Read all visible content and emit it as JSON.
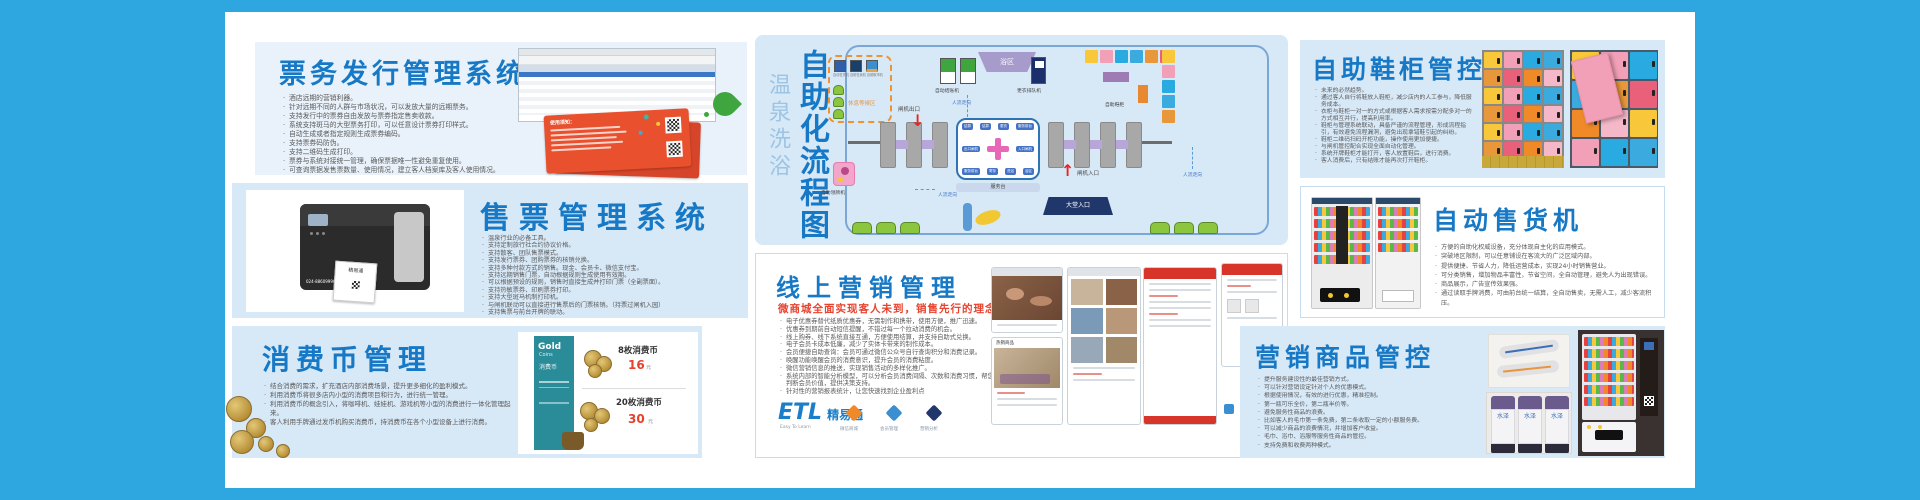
{
  "colors": {
    "frame_blue": "#2EA7E0",
    "panel_blue": "#D7E8F7",
    "title_blue": "#1779C6",
    "accent_red": "#E8432F",
    "dash_orange": "#F0932F",
    "gold_teal": "#2A8C99"
  },
  "ticket_issuing": {
    "title": "票务发行管理系统",
    "bullets": [
      "酒店远期的营销利器。",
      "针对远期不同的人群与市场状况，可以发放大量的远期票务。",
      "支持发行中的票券自由发放与票券指定售卖收款。",
      "系统支持斑马的大型票务打印，可以任意设计票券打印样式。",
      "自动生成或者指定规则生成票券编码。",
      "支持票券码防伪。",
      "支持二维码生成打印。",
      "票券与系统对接统一管理，确保票据唯一性避免重复使用。",
      "可查询票据发售票数量、使用情况，建立客人档案库及客人使用情况。"
    ],
    "ticket_heading": "使用须知："
  },
  "ticket_sales": {
    "title": "售票管理系统",
    "bullets": [
      "温泉行业的必备工具。",
      "支持定制旅行社合约协议价格。",
      "支持散客、团队售票模式。",
      "支持发行票券、团购票券的核销兑换。",
      "支持多种付款方式的销售。现金、会员卡、微信支付宝。",
      "支持远期销售门票，自动根据规则生成使用有效期。",
      "可以根据预设的规则，销售时直接生成并打印门票（全副票面）。",
      "支持热敏票券、印刷票券打印。",
      "支持大型斑马机制打印机。",
      "与闸机联动可以直接进行售票后的门票核销。（持票过闸机入园）",
      "支持售票与前台开牌的联动。"
    ],
    "printer_phone": "024-88609996",
    "printer_label": "精易通"
  },
  "consume_coin": {
    "title": "消费币管理",
    "bullets": [
      "结合消费的需求，扩充酒店内部消费场景，提升更多细化的盈利模式。",
      "利用消费币将很多店内小型的消费项目和行为，进行统一管理。",
      "利用消费币的概念引入，将咖啡机、娃娃机、游戏机等小型的消费进行一体化管理起来。",
      "客人利用手牌通过发币机购买消费币，持消费币在各个小型设备上进行消费。"
    ],
    "card": {
      "brand": "Gold",
      "brand_sub": "Coins",
      "brand_cn": "消费币",
      "item1_name": "8枚消费币",
      "item1_price": "16",
      "item1_unit": "元",
      "item2_name": "20枚消费币",
      "item2_price": "30",
      "item2_unit": "元"
    }
  },
  "flowchart": {
    "title_light": "温泉洗浴",
    "title_bold": "自助化流程图",
    "rest_area": "休息等候区",
    "rest_machines": "自动售货机 自助售卖机 自助取币机",
    "checkout": "自动结账机",
    "flow1": "人流走向",
    "flow2": "人流走向",
    "flow3": "人流走向",
    "gate_exit": "闸机出口",
    "gate_entry": "闸机入口",
    "bath": "浴区",
    "queue_machine": "更衣排队机",
    "shoe_cabinet": "自助鞋柜",
    "service_desk": "服务台",
    "lobby_entry": "大堂入口",
    "card_machine": "自助领牌机",
    "pills_top": [
      "结算",
      "结算",
      "更衣",
      "服务前台"
    ],
    "pills_bottom": [
      "服务前台",
      "寄存",
      "洗浴",
      "浴区"
    ],
    "pill_exit": "出口闸机",
    "pill_entry": "入口闸机"
  },
  "online_marketing": {
    "title": "线上营销管理",
    "subtitle": "微商城全面实现客人未到，销售先行的理念",
    "bullets": [
      "电子优惠券替代纸质优惠券，无需制作和携带，使用方便，推广迅速。",
      "优惠券到期前自动短信提醒，不错过每一个拉动消费的机会。",
      "线上购券、线下系统直接互通，方便使用结算，并支持自助式兑换。",
      "电子会员卡成本低廉，减少了实体卡带来的制作成本。",
      "会员便捷自助查询：会员可通过微信公众号自行查询积分和消费记录。",
      "唤醒功能唤醒会员的消费意识，提升会员的消费粘度。",
      "微信营销信息的推送，实现销售活动的多样化推广。",
      "系统内部的智能分析模型，可以分析会员消费间隔、次数和消费习惯，帮您精准判断会员价值，提供决策支持。",
      "针对性的营销报表统计，让您快速找到企业盈利点"
    ],
    "hot_label": "热销商品",
    "logo": {
      "etl": "ETL",
      "name": "精易通",
      "tagline": "Easy To Learn"
    },
    "feature_caps": [
      "微信商城",
      "会员管理",
      "营销分析"
    ]
  },
  "shoe_cabinet": {
    "title": "自助鞋柜管控",
    "bullets": [
      "未来的必然趋势。",
      "通过客人自行将鞋放入鞋柜，减少店内的人工参与，降低服务成本。",
      "衣柜与鞋柜一对一的方式或根据客人需求按需分配多对一的方式相互并行，提高利用率。",
      "鞋柜与管理系统联动，具备严谨的流程管理，形成流程指引，有效避免流程漏洞，避免出现拿错鞋引起的纠纷。",
      "鞋柜二维码扫码开柜功能，操作使用更加便捷。",
      "与闸机管控配合实现全面自动化管理。",
      "系统开牌鞋柜才能打开，客人放置鞋后，进行消费。",
      "客人消费后，只有结账才能再次打开鞋柜。"
    ]
  },
  "vending": {
    "title": "自动售货机",
    "bullets": [
      "方便的自助化权威设备，充分体现自主化的应用模式。",
      "突破地区限制，可以任意铺设在客流大的广泛区域内部。",
      "提供便捷、节省人力，降低运营成本，实现24小时销售营业。",
      "可分类销售，增加物品丰富性，节省空间，全自动管理，避免人为出现错误。",
      "商品展示，广告宣传效果强。",
      "通过读取手牌消费，可由前台统一结算，全自动售卖，无需人工，减少客流积压。"
    ]
  },
  "marketing_goods": {
    "title": "营销商品管控",
    "bullets": [
      "提升服务建设性的最佳营销方式。",
      "可以针对营销设定针对个人的优惠模式。",
      "根据使用情况，有效的进行优惠，精准控制。",
      "第一瓶可乐全价，第二瓶半价等。",
      "避免服务性商品的浪费。",
      "比如客人的毛巾第一条免费，第二条收取一定的小额服务费。",
      "可以减少商品的浪费情况，并增加客户收益。",
      "毛巾、浴巾、浴服等服务性商品的管控。",
      "支持免费和收费两种模式。"
    ],
    "bottle_text": "水泽"
  },
  "decor": {
    "locker_palette": [
      "#F2A0B8",
      "#F08A28",
      "#3BAADF",
      "#F8C83A",
      "#E8607A",
      "#29ABE2",
      "#F5B8C8",
      "#E8983A"
    ]
  }
}
